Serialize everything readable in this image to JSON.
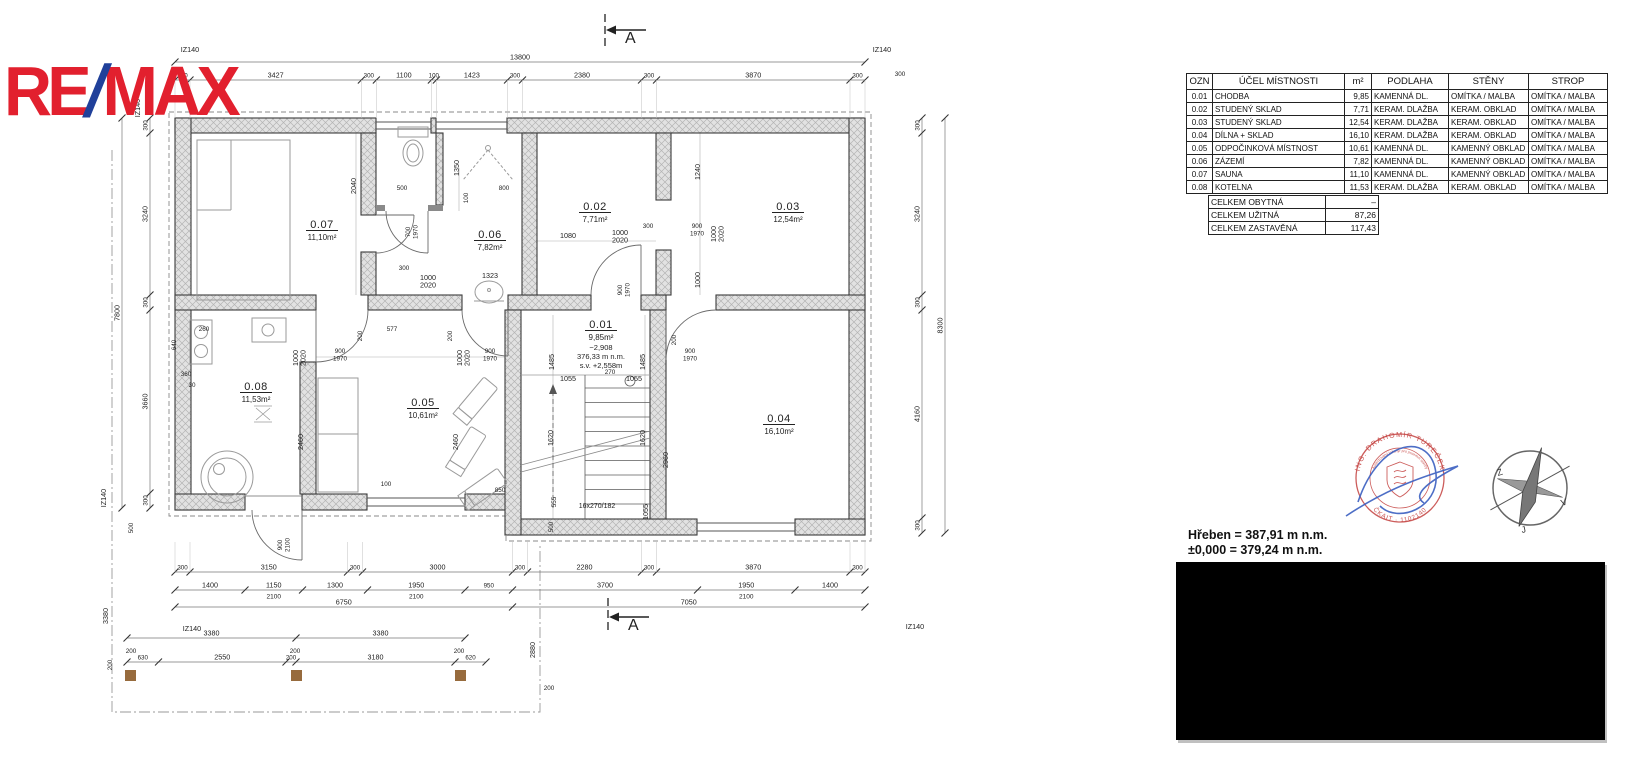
{
  "logo": {
    "re": "RE",
    "slash": "/",
    "max": "MAX"
  },
  "schedule": {
    "headers": [
      "OZN",
      "ÚČEL  MÍSTNOSTI",
      "m²",
      "PODLAHA",
      "STĚNY",
      "STROP"
    ],
    "rows": [
      [
        "0.01",
        "CHODBA",
        "9,85",
        "KAMENNÁ  DL.",
        "OMÍTKA  /  MALBA",
        "OMÍTKA  /  MALBA"
      ],
      [
        "0.02",
        "STUDENÝ  SKLAD",
        "7,71",
        "KERAM.  DLAŽBA",
        "KERAM.  OBKLAD",
        "OMÍTKA  /  MALBA"
      ],
      [
        "0.03",
        "STUDENÝ  SKLAD",
        "12,54",
        "KERAM.  DLAŽBA",
        "KERAM.  OBKLAD",
        "OMÍTKA  /  MALBA"
      ],
      [
        "0.04",
        "DÍLNA  +  SKLAD",
        "16,10",
        "KERAM.  DLAŽBA",
        "KERAM.  OBKLAD",
        "OMÍTKA  /  MALBA"
      ],
      [
        "0.05",
        "ODPOČINKOVÁ  MÍSTNOST",
        "10,61",
        "KAMENNÁ  DL.",
        "KAMENNÝ  OBKLAD",
        "OMÍTKA  /  MALBA"
      ],
      [
        "0.06",
        "ZÁZEMÍ",
        "7,82",
        "KAMENNÁ  DL.",
        "KAMENNÝ  OBKLAD",
        "OMÍTKA  /  MALBA"
      ],
      [
        "0.07",
        "SAUNA",
        "11,10",
        "KAMENNÁ  DL.",
        "KAMENNÝ  OBKLAD",
        "OMÍTKA  /  MALBA"
      ],
      [
        "0.08",
        "KOTELNA",
        "11,53",
        "KERAM.  DLAŽBA",
        "KERAM.  OBKLAD",
        "OMÍTKA  /  MALBA"
      ]
    ],
    "summary": [
      {
        "label": "CELKEM  OBYTNÁ",
        "value": "–"
      },
      {
        "label": "CELKEM  UŽITNÁ",
        "value": "87,26"
      },
      {
        "label": "CELKEM  ZASTAVĚNÁ",
        "value": "117,43"
      }
    ]
  },
  "levels": {
    "line1": "Hřeben = 387,91 m n.m.",
    "line2": "±0,000 = 379,24 m n.m."
  },
  "section": {
    "label": "A"
  },
  "stamp": {
    "arc_top": "ING. DRAHOMÍR TUREČEK",
    "arc_mid": "Autorizovaný inženýr pro pozemní stavby",
    "arc_bottom": "ČKAIT · 1102140"
  },
  "compass": {
    "west": "Z",
    "east": "V",
    "south": "J"
  },
  "colors": {
    "logo_red": "#e2202e",
    "logo_blue": "#20409a",
    "stamp_red": "#c4413f",
    "signature_blue": "#3a5fc0"
  },
  "plan": {
    "stair_note": "16x270/182",
    "rooms": [
      {
        "id": "0.07",
        "area": "11,10m²",
        "x": 322,
        "y": 228
      },
      {
        "id": "0.06",
        "area": "7,82m²",
        "x": 490,
        "y": 238
      },
      {
        "id": "0.02",
        "area": "7,71m²",
        "x": 595,
        "y": 210
      },
      {
        "id": "0.03",
        "area": "12,54m²",
        "x": 788,
        "y": 210
      },
      {
        "id": "0.08",
        "area": "11,53m²",
        "x": 256,
        "y": 390
      },
      {
        "id": "0.05",
        "area": "10,61m²",
        "x": 423,
        "y": 406
      },
      {
        "id": "0.04",
        "area": "16,10m²",
        "x": 779,
        "y": 422
      },
      {
        "id": "0.01",
        "area": "9,85m²",
        "x": 601,
        "y": 328,
        "extra": [
          "−2,908",
          "376,33  m  n.m.",
          "s.v. +2,558m"
        ]
      }
    ],
    "chains": [
      {
        "dir": "h",
        "x": 175,
        "y": 62,
        "segs": [
          {
            "len": 13800,
            "t": "13800"
          }
        ]
      },
      {
        "dir": "h",
        "x": 175,
        "y": 80,
        "ext": 38,
        "segs": [
          {
            "len": 300,
            "t": "300"
          },
          {
            "len": 3427,
            "t": "3427"
          },
          {
            "len": 300,
            "t": "300"
          },
          {
            "len": 1100,
            "t": "1100"
          },
          {
            "len": 100,
            "t": "100"
          },
          {
            "len": 1423,
            "t": "1423"
          },
          {
            "len": 300,
            "t": "300"
          },
          {
            "len": 2380,
            "t": "2380"
          },
          {
            "len": 300,
            "t": "300"
          },
          {
            "len": 3870,
            "t": "3870"
          },
          {
            "len": 300,
            "t": "300"
          }
        ]
      },
      {
        "dir": "h",
        "x": 175,
        "y": 572,
        "ext": -30,
        "segs": [
          {
            "len": 300,
            "t": "300"
          },
          {
            "len": 3150,
            "t": "3150"
          },
          {
            "len": 300,
            "t": "300"
          },
          {
            "len": 3000,
            "t": "3000"
          },
          {
            "len": 300,
            "t": "300"
          },
          {
            "len": 2280,
            "t": "2280"
          },
          {
            "len": 300,
            "t": "300"
          },
          {
            "len": 3870,
            "t": "3870"
          },
          {
            "len": 300,
            "t": "300"
          }
        ]
      },
      {
        "dir": "h",
        "x": 175,
        "y": 590,
        "segs": [
          {
            "len": 1400,
            "t": "1400"
          },
          {
            "len": 1150,
            "t": "1150",
            "sub": "2100"
          },
          {
            "len": 1300,
            "t": "1300"
          },
          {
            "len": 1950,
            "t": "1950",
            "sub": "2100"
          },
          {
            "len": 950,
            "t": "950"
          },
          {
            "len": 3700,
            "t": "3700"
          },
          {
            "len": 1950,
            "t": "1950",
            "sub": "2100"
          },
          {
            "len": 1400,
            "t": "1400"
          }
        ]
      },
      {
        "dir": "h",
        "x": 175,
        "y": 607,
        "segs": [
          {
            "len": 6750,
            "t": "6750"
          },
          {
            "len": 7050,
            "t": "7050"
          }
        ]
      },
      {
        "dir": "h",
        "x": 127,
        "y": 638,
        "segs": [
          {
            "len": 3380,
            "t": "3380"
          },
          {
            "len": 3380,
            "t": "3380"
          }
        ]
      },
      {
        "dir": "h",
        "x": 127,
        "y": 662,
        "segs": [
          {
            "len": 630,
            "t": "630"
          },
          {
            "len": 2550,
            "t": "2550"
          },
          {
            "len": 200,
            "t": "200"
          },
          {
            "len": 3180,
            "t": "3180"
          },
          {
            "len": 620,
            "t": "620"
          }
        ]
      },
      {
        "dir": "v",
        "x": 150,
        "y": 118,
        "segs": [
          {
            "len": 300,
            "t": "300"
          },
          {
            "len": 3240,
            "t": "3240"
          },
          {
            "len": 300,
            "t": "300"
          },
          {
            "len": 3660,
            "t": "3660"
          },
          {
            "len": 300,
            "t": "300"
          }
        ]
      },
      {
        "dir": "v",
        "x": 122,
        "y": 118,
        "segs": [
          {
            "len": 7800,
            "t": "7800"
          }
        ]
      },
      {
        "dir": "v",
        "x": 922,
        "y": 118,
        "segs": [
          {
            "len": 300,
            "t": "300"
          },
          {
            "len": 3240,
            "t": "3240"
          },
          {
            "len": 300,
            "t": "300"
          },
          {
            "len": 4160,
            "t": "4160"
          },
          {
            "len": 300,
            "t": "300"
          }
        ]
      },
      {
        "dir": "v",
        "x": 945,
        "y": 118,
        "segs": [
          {
            "len": 8300,
            "t": "8300"
          }
        ]
      }
    ],
    "texts": [
      {
        "x": 402,
        "y": 190,
        "t": "500"
      },
      {
        "x": 356,
        "y": 186,
        "t": "2040",
        "rot": 1
      },
      {
        "x": 468,
        "y": 198,
        "t": "100",
        "rot": 1
      },
      {
        "x": 504,
        "y": 190,
        "t": "800"
      },
      {
        "x": 459,
        "y": 168,
        "t": "1350",
        "rot": 1
      },
      {
        "x": 410,
        "y": 232,
        "t": "700",
        "sub": "1970",
        "rot": 1
      },
      {
        "x": 568,
        "y": 238,
        "t": "1080"
      },
      {
        "x": 620,
        "y": 235,
        "t": "1000",
        "sub": "2020"
      },
      {
        "x": 648,
        "y": 228,
        "t": "300"
      },
      {
        "x": 622,
        "y": 290,
        "t": "900",
        "sub": "1970",
        "rot": 1
      },
      {
        "x": 700,
        "y": 172,
        "t": "1240",
        "rot": 1
      },
      {
        "x": 697,
        "y": 228,
        "t": "900",
        "sub": "1970"
      },
      {
        "x": 716,
        "y": 234,
        "t": "1000",
        "sub": "2020",
        "rot": 1
      },
      {
        "x": 700,
        "y": 280,
        "t": "1000",
        "rot": 1
      },
      {
        "x": 490,
        "y": 278,
        "t": "1323"
      },
      {
        "x": 428,
        "y": 280,
        "t": "1000",
        "sub": "2020"
      },
      {
        "x": 404,
        "y": 270,
        "t": "300"
      },
      {
        "x": 392,
        "y": 331,
        "t": "577"
      },
      {
        "x": 362,
        "y": 336,
        "t": "200",
        "rot": 1
      },
      {
        "x": 452,
        "y": 336,
        "t": "200",
        "rot": 1
      },
      {
        "x": 298,
        "y": 358,
        "t": "1000",
        "sub": "2020",
        "rot": 1
      },
      {
        "x": 462,
        "y": 358,
        "t": "1000",
        "sub": "2020",
        "rot": 1
      },
      {
        "x": 340,
        "y": 353,
        "t": "900",
        "sub": "1970"
      },
      {
        "x": 490,
        "y": 353,
        "t": "900",
        "sub": "1970"
      },
      {
        "x": 176,
        "y": 345,
        "t": "640",
        "rot": 1
      },
      {
        "x": 204,
        "y": 331,
        "t": "260"
      },
      {
        "x": 186,
        "y": 376,
        "t": "360"
      },
      {
        "x": 192,
        "y": 387,
        "t": "30"
      },
      {
        "x": 303,
        "y": 442,
        "t": "2460",
        "rot": 1
      },
      {
        "x": 458,
        "y": 442,
        "t": "2460",
        "rot": 1
      },
      {
        "x": 386,
        "y": 486,
        "t": "100"
      },
      {
        "x": 500,
        "y": 492,
        "t": "850"
      },
      {
        "x": 282,
        "y": 545,
        "t": "900",
        "sub": "2100",
        "rot": 1
      },
      {
        "x": 554,
        "y": 362,
        "t": "1485",
        "rot": 1
      },
      {
        "x": 645,
        "y": 362,
        "t": "1485",
        "rot": 1
      },
      {
        "x": 568,
        "y": 381,
        "t": "1055"
      },
      {
        "x": 634,
        "y": 381,
        "t": "1055"
      },
      {
        "x": 610,
        "y": 374,
        "t": "270"
      },
      {
        "x": 553,
        "y": 438,
        "t": "1620",
        "rot": 1
      },
      {
        "x": 645,
        "y": 438,
        "t": "1620",
        "rot": 1
      },
      {
        "x": 556,
        "y": 502,
        "t": "555",
        "rot": 1
      },
      {
        "x": 553,
        "y": 527,
        "t": "500",
        "rot": 1
      },
      {
        "x": 648,
        "y": 512,
        "t": "1055",
        "rot": 1
      },
      {
        "x": 668,
        "y": 460,
        "t": "2960",
        "rot": 1
      },
      {
        "x": 676,
        "y": 340,
        "t": "200",
        "rot": 1
      },
      {
        "x": 690,
        "y": 353,
        "t": "900",
        "sub": "1970"
      },
      {
        "x": 535,
        "y": 650,
        "t": "2880",
        "rot": 1
      },
      {
        "x": 549,
        "y": 690,
        "t": "200"
      },
      {
        "x": 108,
        "y": 616,
        "t": "3380",
        "rot": 1
      },
      {
        "x": 112,
        "y": 665,
        "t": "200",
        "rot": 1
      },
      {
        "x": 133,
        "y": 528,
        "t": "500",
        "rot": 1
      },
      {
        "x": 106,
        "y": 498,
        "t": "IZ140",
        "rot": 1
      },
      {
        "x": 140,
        "y": 108,
        "t": "IZ140",
        "rot": 1
      },
      {
        "x": 190,
        "y": 52,
        "t": "IZ140"
      },
      {
        "x": 882,
        "y": 52,
        "t": "IZ140"
      },
      {
        "x": 900,
        "y": 76,
        "t": "300"
      },
      {
        "x": 192,
        "y": 631,
        "t": "IZ140"
      },
      {
        "x": 915,
        "y": 629,
        "t": "IZ140"
      },
      {
        "x": 131,
        "y": 653,
        "t": "200"
      },
      {
        "x": 295,
        "y": 653,
        "t": "200"
      },
      {
        "x": 459,
        "y": 653,
        "t": "200"
      }
    ]
  }
}
